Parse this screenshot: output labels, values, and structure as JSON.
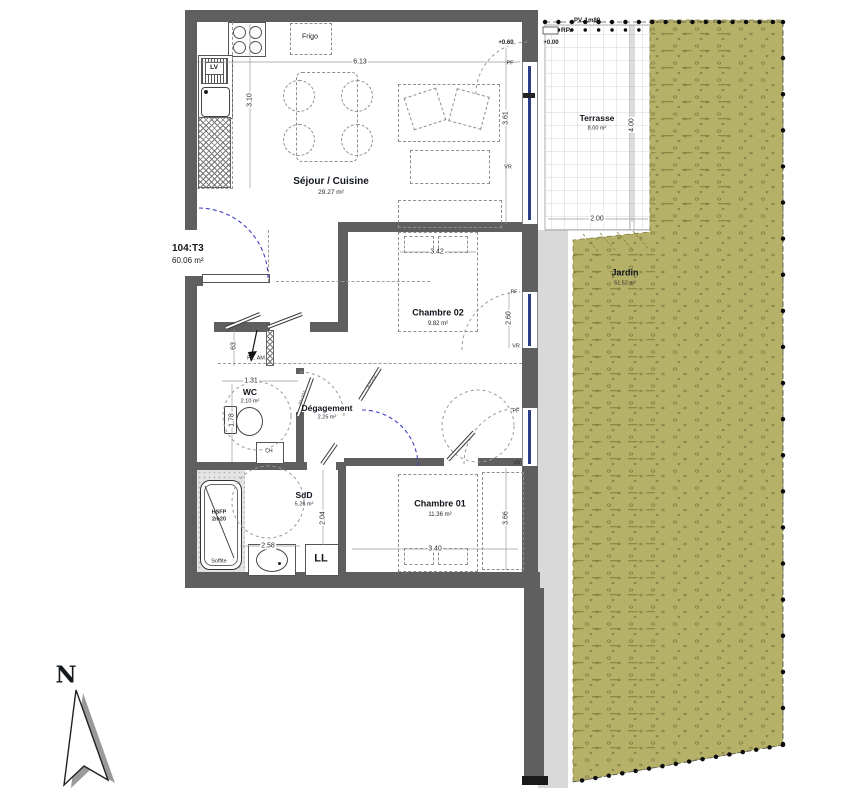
{
  "unit": {
    "id": "104:T3",
    "area": "60.06 m²"
  },
  "rooms": {
    "sejour": {
      "name": "Séjour / Cuisine",
      "area": "29.27 m²"
    },
    "chambre02": {
      "name": "Chambre 02",
      "area": "9.82 m²"
    },
    "chambre01": {
      "name": "Chambre 01",
      "area": "11.36 m²"
    },
    "wc": {
      "name": "WC",
      "area": "2.10 m²"
    },
    "degagement": {
      "name": "Dégagement",
      "area": "2.25 m²"
    },
    "sdd": {
      "name": "SdD",
      "area": "5.26 m²"
    },
    "terrasse": {
      "name": "Terrasse",
      "area": "8.00 m²"
    },
    "jardin": {
      "name": "Jardin",
      "area": "51.52 m²"
    }
  },
  "fixtures": {
    "frigo": "Frigo",
    "lv": "LV",
    "ll": "LL",
    "ch": "CH",
    "closet": "PL. AM",
    "hsfp_line1": "HSFP",
    "hsfp_line2": "2m20",
    "soffite": "Soffite"
  },
  "annotations": {
    "rp": "RP.",
    "pv": "PV. 1m80",
    "level_terrace": "+0.60",
    "level_garden": "+0.00",
    "pf": "PF",
    "vr": "VR",
    "north": "N",
    "door_size_90": "90x204",
    "door_size_80": "80x204"
  },
  "dimensions": {
    "living_width": "6.13",
    "kitchen_depth": "3.10",
    "living_window": "3.61",
    "terrace_length": "4.00",
    "terrace_width": "2.00",
    "chambre02_width": "3.42",
    "chambre02_window": "2.60",
    "wc_width": "1.31",
    "wc_depth": "1.78",
    "closet_width": "63",
    "sdd_width": "2.58",
    "sdd_depth": "2.04",
    "chambre01_width": "3.40",
    "chambre01_depth": "3.66"
  },
  "colors": {
    "wall": "#5f5f5f",
    "garden": "#b6b169",
    "walkway": "#d9d9d9",
    "swing": "#4040c0",
    "glazing": "#2b3e83"
  }
}
